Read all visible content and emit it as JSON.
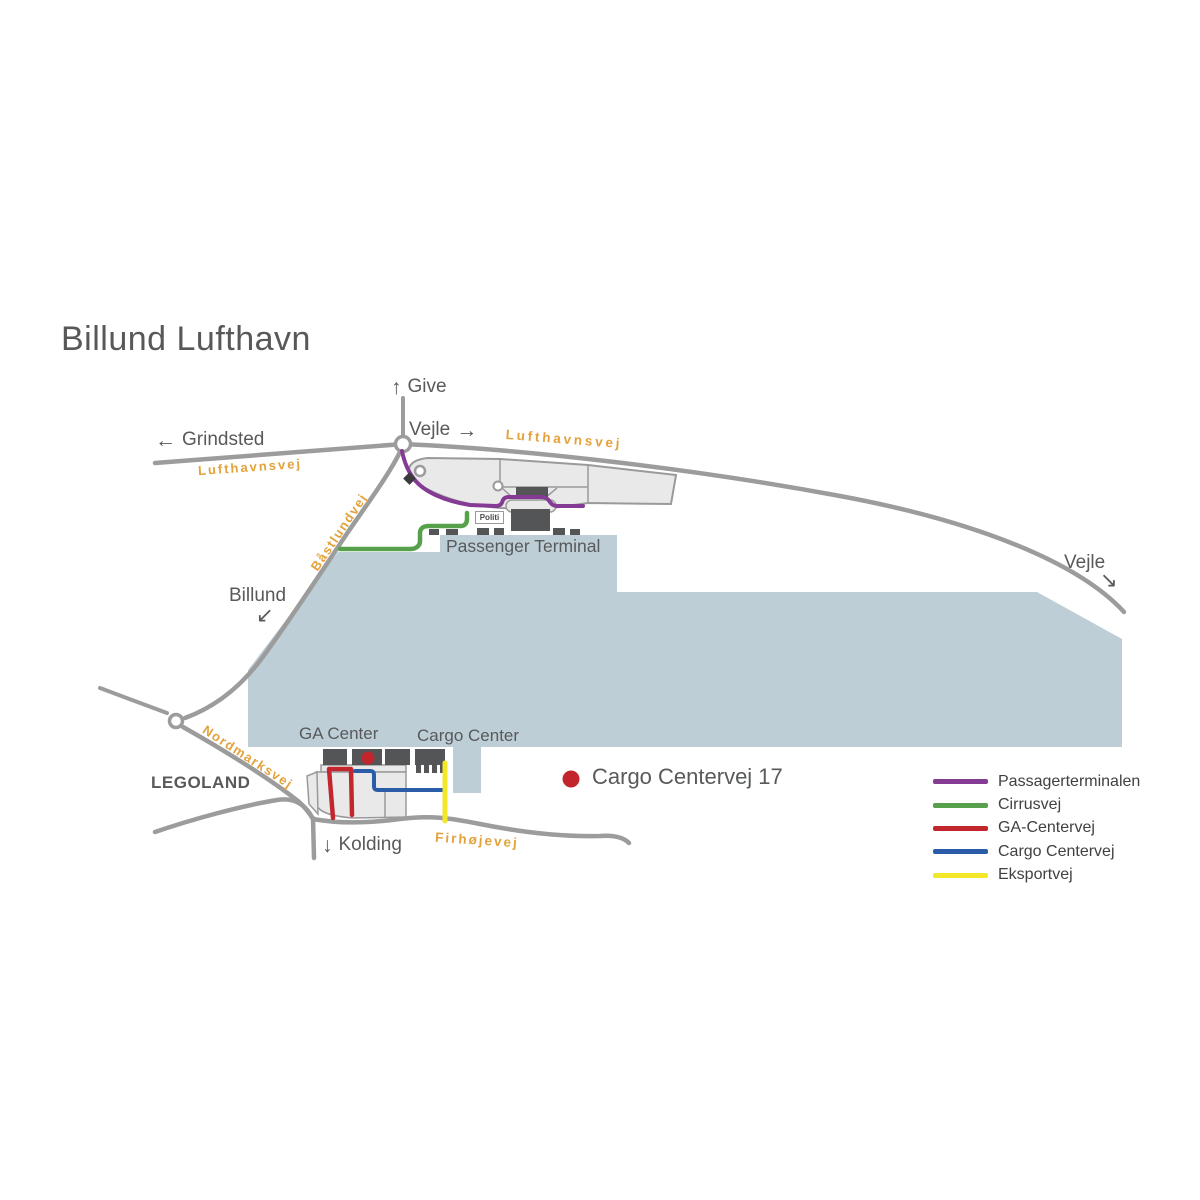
{
  "title": "Billund Lufthavn",
  "directions": {
    "give": {
      "arrow": "↑",
      "label": "Give"
    },
    "vejle_top": {
      "label": "Vejle",
      "arrow": "→"
    },
    "grindsted": {
      "arrow": "←",
      "label": "Grindsted"
    },
    "billund": {
      "label": "Billund",
      "arrow": "↙"
    },
    "vejle_right": {
      "label": "Vejle",
      "arrow": "↘"
    },
    "kolding": {
      "arrow": "↓",
      "label": "Kolding"
    }
  },
  "road_labels": {
    "lufthavnsvej_left": "Lufthavnsvej",
    "lufthavnsvej_right": "Lufthavnsvej",
    "bastlundvej": "Båstlundvej",
    "nordmarksvej": "Nordmarksvej",
    "firhojevej": "Firhøjevej"
  },
  "places": {
    "passenger_terminal": "Passenger Terminal",
    "politi": "Politi",
    "ga_center": "GA Center",
    "cargo_center": "Cargo Center",
    "legoland": "LEGOLAND"
  },
  "marker": {
    "label": "Cargo Centervej 17",
    "color": "#c2262c"
  },
  "legend": {
    "items": [
      {
        "label": "Passagerterminalen",
        "color": "#853a94"
      },
      {
        "label": "Cirrusvej",
        "color": "#57a14c"
      },
      {
        "label": "GA-Centervej",
        "color": "#c2272d"
      },
      {
        "label": "Cargo Centervej",
        "color": "#2b5ca8"
      },
      {
        "label": "Eksportvej",
        "color": "#f3e72a"
      }
    ]
  },
  "colors": {
    "airfield_area": "#bdced6",
    "road": "#9c9c9c",
    "parking": "#e9e9e9",
    "building": "#545557",
    "text": "#58595b",
    "road_label_orange": "#e3a23b"
  }
}
